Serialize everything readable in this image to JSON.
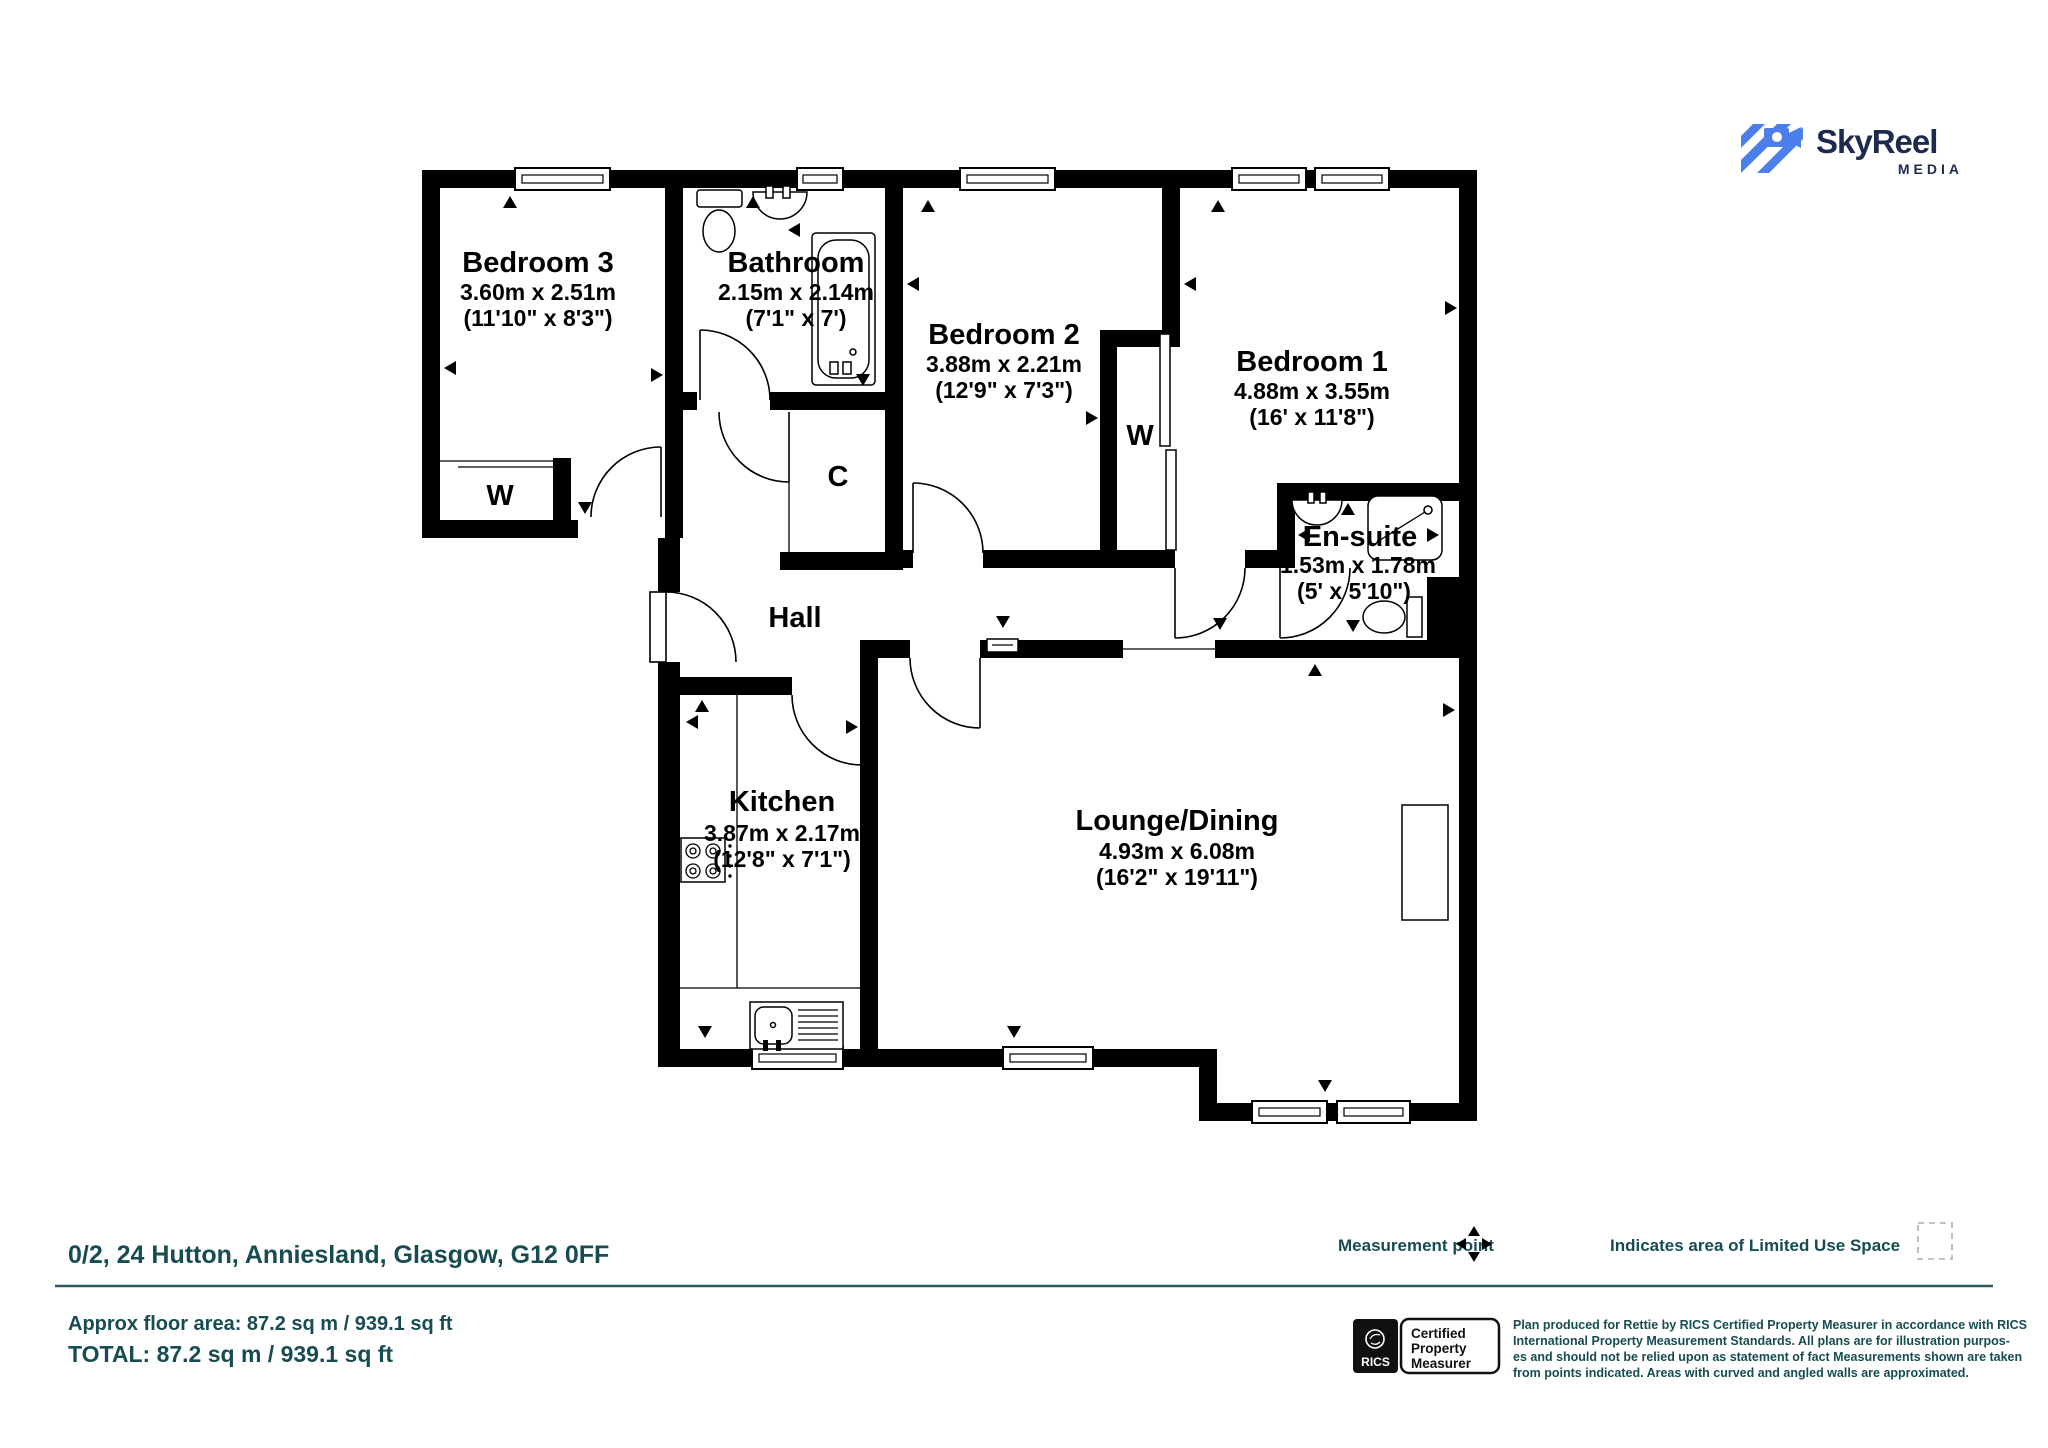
{
  "plan": {
    "rooms": [
      {
        "name": "Bedroom 3",
        "metric": "3.60m x 2.51m",
        "imperial": "(11'10\" x 8'3\")"
      },
      {
        "name": "Bathroom",
        "metric": "2.15m x 2.14m",
        "imperial": "(7'1\" x 7')"
      },
      {
        "name": "Bedroom 2",
        "metric": "3.88m x 2.21m",
        "imperial": "(12'9\" x 7'3\")"
      },
      {
        "name": "Bedroom 1",
        "metric": "4.88m x 3.55m",
        "imperial": "(16' x 11'8\")"
      },
      {
        "name": "En-suite",
        "metric": "1.53m x 1.78m",
        "imperial": "(5' x 5'10\")"
      },
      {
        "name": "Kitchen",
        "metric": "3.87m x 2.17m",
        "imperial": "(12'8\" x 7'1\")"
      },
      {
        "name": "Lounge/Dining",
        "metric": "4.93m x 6.08m",
        "imperial": "(16'2\" x 19'11\")"
      }
    ],
    "hall": "Hall",
    "wardrobe_bed3": "W",
    "wardrobe_mid": "W",
    "cupboard": "C"
  },
  "logo": {
    "brand": "SkyReel",
    "tagline": "MEDIA"
  },
  "footer": {
    "address": "0/2, 24 Hutton, Anniesland, Glasgow, G12 0FF",
    "approx_area": "Approx floor area: 87.2 sq m / 939.1 sq ft",
    "total_area": "TOTAL: 87.2 sq m / 939.1 sq ft",
    "legend_measurement": "Measurement point",
    "legend_limited_use": "Indicates area of  Limited Use Space",
    "rics_name": "RICS",
    "rics_badge": [
      "Certified",
      "Property",
      "Measurer"
    ],
    "disclaimer": [
      "Plan produced for Rettie by RICS Certified Property Measurer in accordance with RICS",
      "International Property  Measurement Standards.  All plans are for illustration purpos-",
      "es and should not be relied upon as statement of fact Measurements shown are taken",
      "from points indicated. Areas with curved and angled walls are approximated."
    ]
  },
  "colors": {
    "teal": "#174C52",
    "logo_blue": "#4C7FE9",
    "logo_navy": "#1C2B4D",
    "wall": "#000000"
  }
}
